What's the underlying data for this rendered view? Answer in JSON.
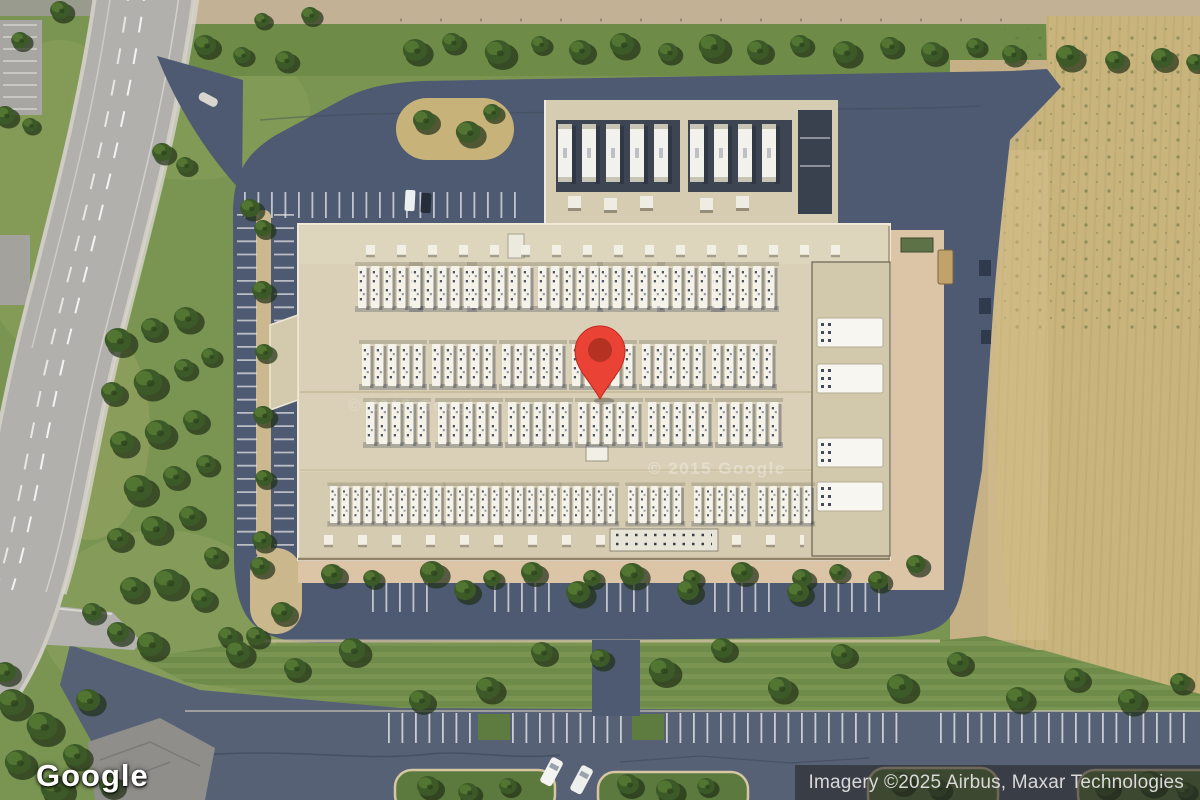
{
  "map": {
    "view_type": "satellite",
    "pin": {
      "color": "#EA4335",
      "inner_dot_color": "#B0301F"
    },
    "watermarks": [
      {
        "text": "© 2015 Google"
      },
      {
        "text": "© 2015 Google"
      }
    ]
  },
  "branding": {
    "google_logo_text": "Google"
  },
  "attribution": {
    "text": "Imagery ©2025 Airbus, Maxar Technologies"
  },
  "scene": {
    "description": "Aerial satellite view of a large beige industrial building with rows of white rooftop HVAC units, surrounded by a dark asphalt parking ring, green landscaping with trees, a curved public road on the left, a wide parking road along the bottom, and a dry tan field on the right; red location pin at center",
    "colors": {
      "building_roof": "#d9d0b7",
      "parking_asphalt": "#4e5a71",
      "public_road": "#b1b0ac",
      "grass": "#7a9552",
      "trees": "#3c5a28",
      "field": "#c9b47c",
      "sidewalk_apron": "#dcc4a7"
    }
  }
}
